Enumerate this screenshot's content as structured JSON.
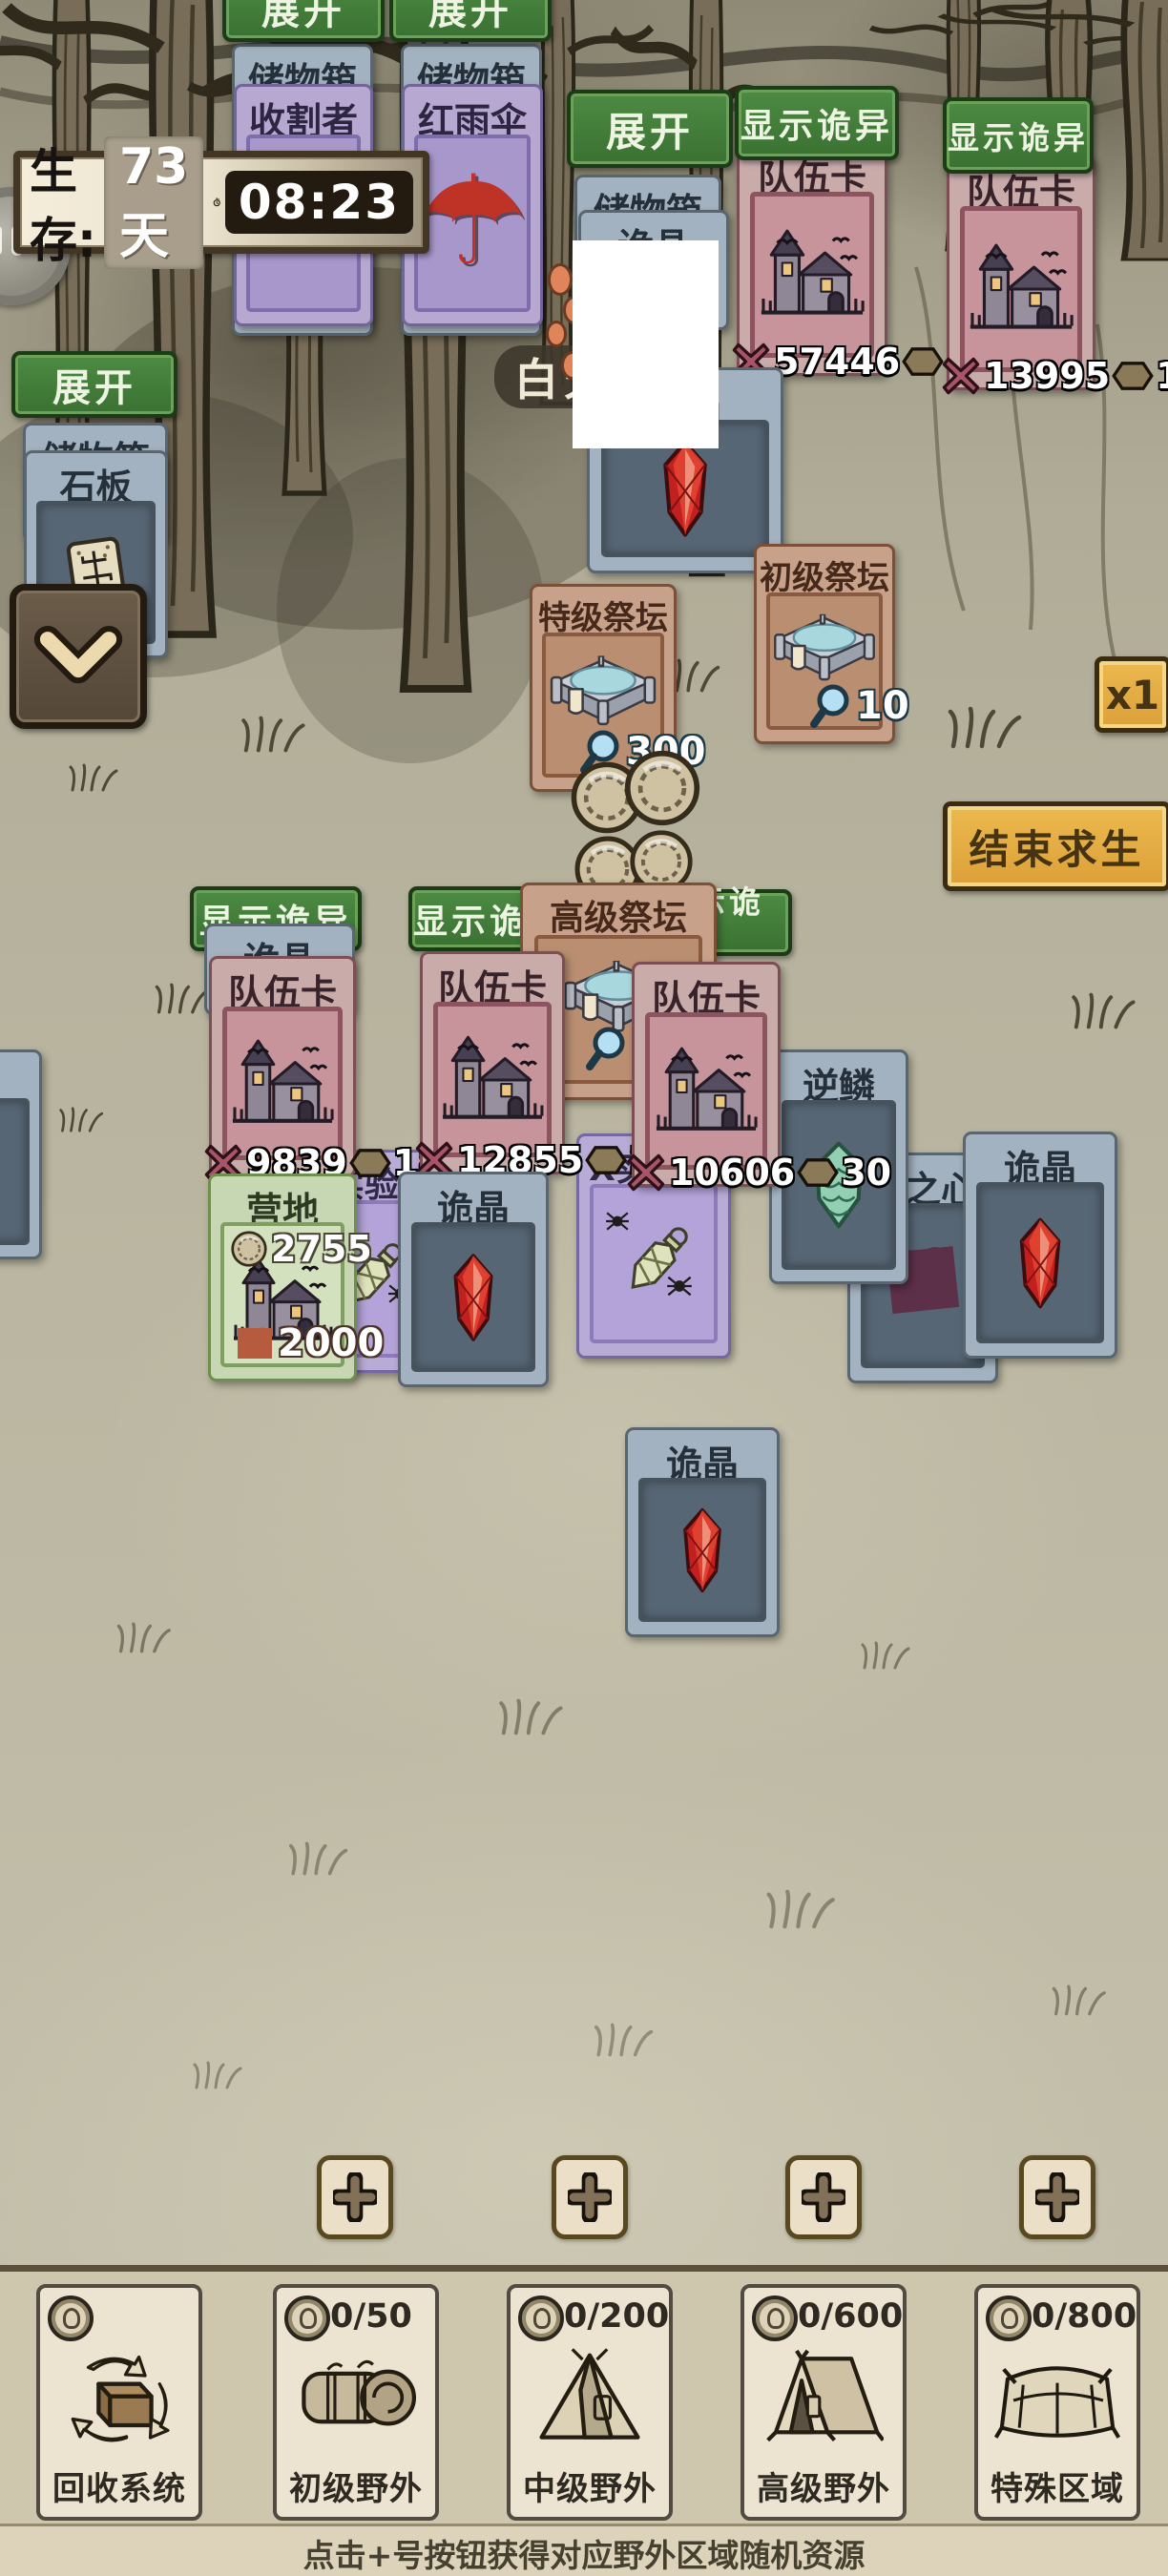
{
  "hud": {
    "survival_label": "生存:",
    "days": "73天",
    "time": "08:23",
    "day_phase": "白天",
    "speed": "x1",
    "end_survival": "结束求生"
  },
  "buttons": {
    "expand": "展开",
    "show_weird": "显示诡异"
  },
  "cards": {
    "storage": "储物箱",
    "harvester": "收割者",
    "umbrella": "红雨伞",
    "slate": "石板",
    "crystal": "诡晶",
    "team": "队伍卡",
    "experiment": "X实验品",
    "scale": "逆鳞",
    "heart": "异之心",
    "special_altar": {
      "title": "特级祭坛",
      "value": "300"
    },
    "primary_altar": {
      "title": "初级祭坛",
      "value": "10"
    },
    "advanced_altar": {
      "title": "高级祭坛",
      "value": "10"
    },
    "camp": {
      "title": "营地",
      "coins": "2755",
      "hp": "2000"
    },
    "team_stats": [
      {
        "atk": "57446",
        "def": "53"
      },
      {
        "atk": "13995",
        "def": "183"
      },
      {
        "atk": "9839",
        "def": "18"
      },
      {
        "atk": "12855",
        "def": "24"
      },
      {
        "atk": "10606",
        "def": "30"
      }
    ]
  },
  "bottom_bar": {
    "slots": [
      {
        "label": "回收系统",
        "count": ""
      },
      {
        "label": "初级野外",
        "count": "0/50"
      },
      {
        "label": "中级野外",
        "count": "0/200"
      },
      {
        "label": "高级野外",
        "count": "0/600"
      },
      {
        "label": "特殊区域",
        "count": "0/800"
      }
    ],
    "hint": "点击+号按钮获得对应野外区域随机资源"
  },
  "colors": {
    "accent_green": "#3f7a38",
    "accent_gold": "#e2aa43",
    "card_pink": "#c9abaa",
    "card_blue": "#a3b2c0",
    "card_purple": "#b6a8d1",
    "card_tan": "#c7a189",
    "card_green": "#c8d7b3",
    "crystal_red": "#cf2d22"
  }
}
